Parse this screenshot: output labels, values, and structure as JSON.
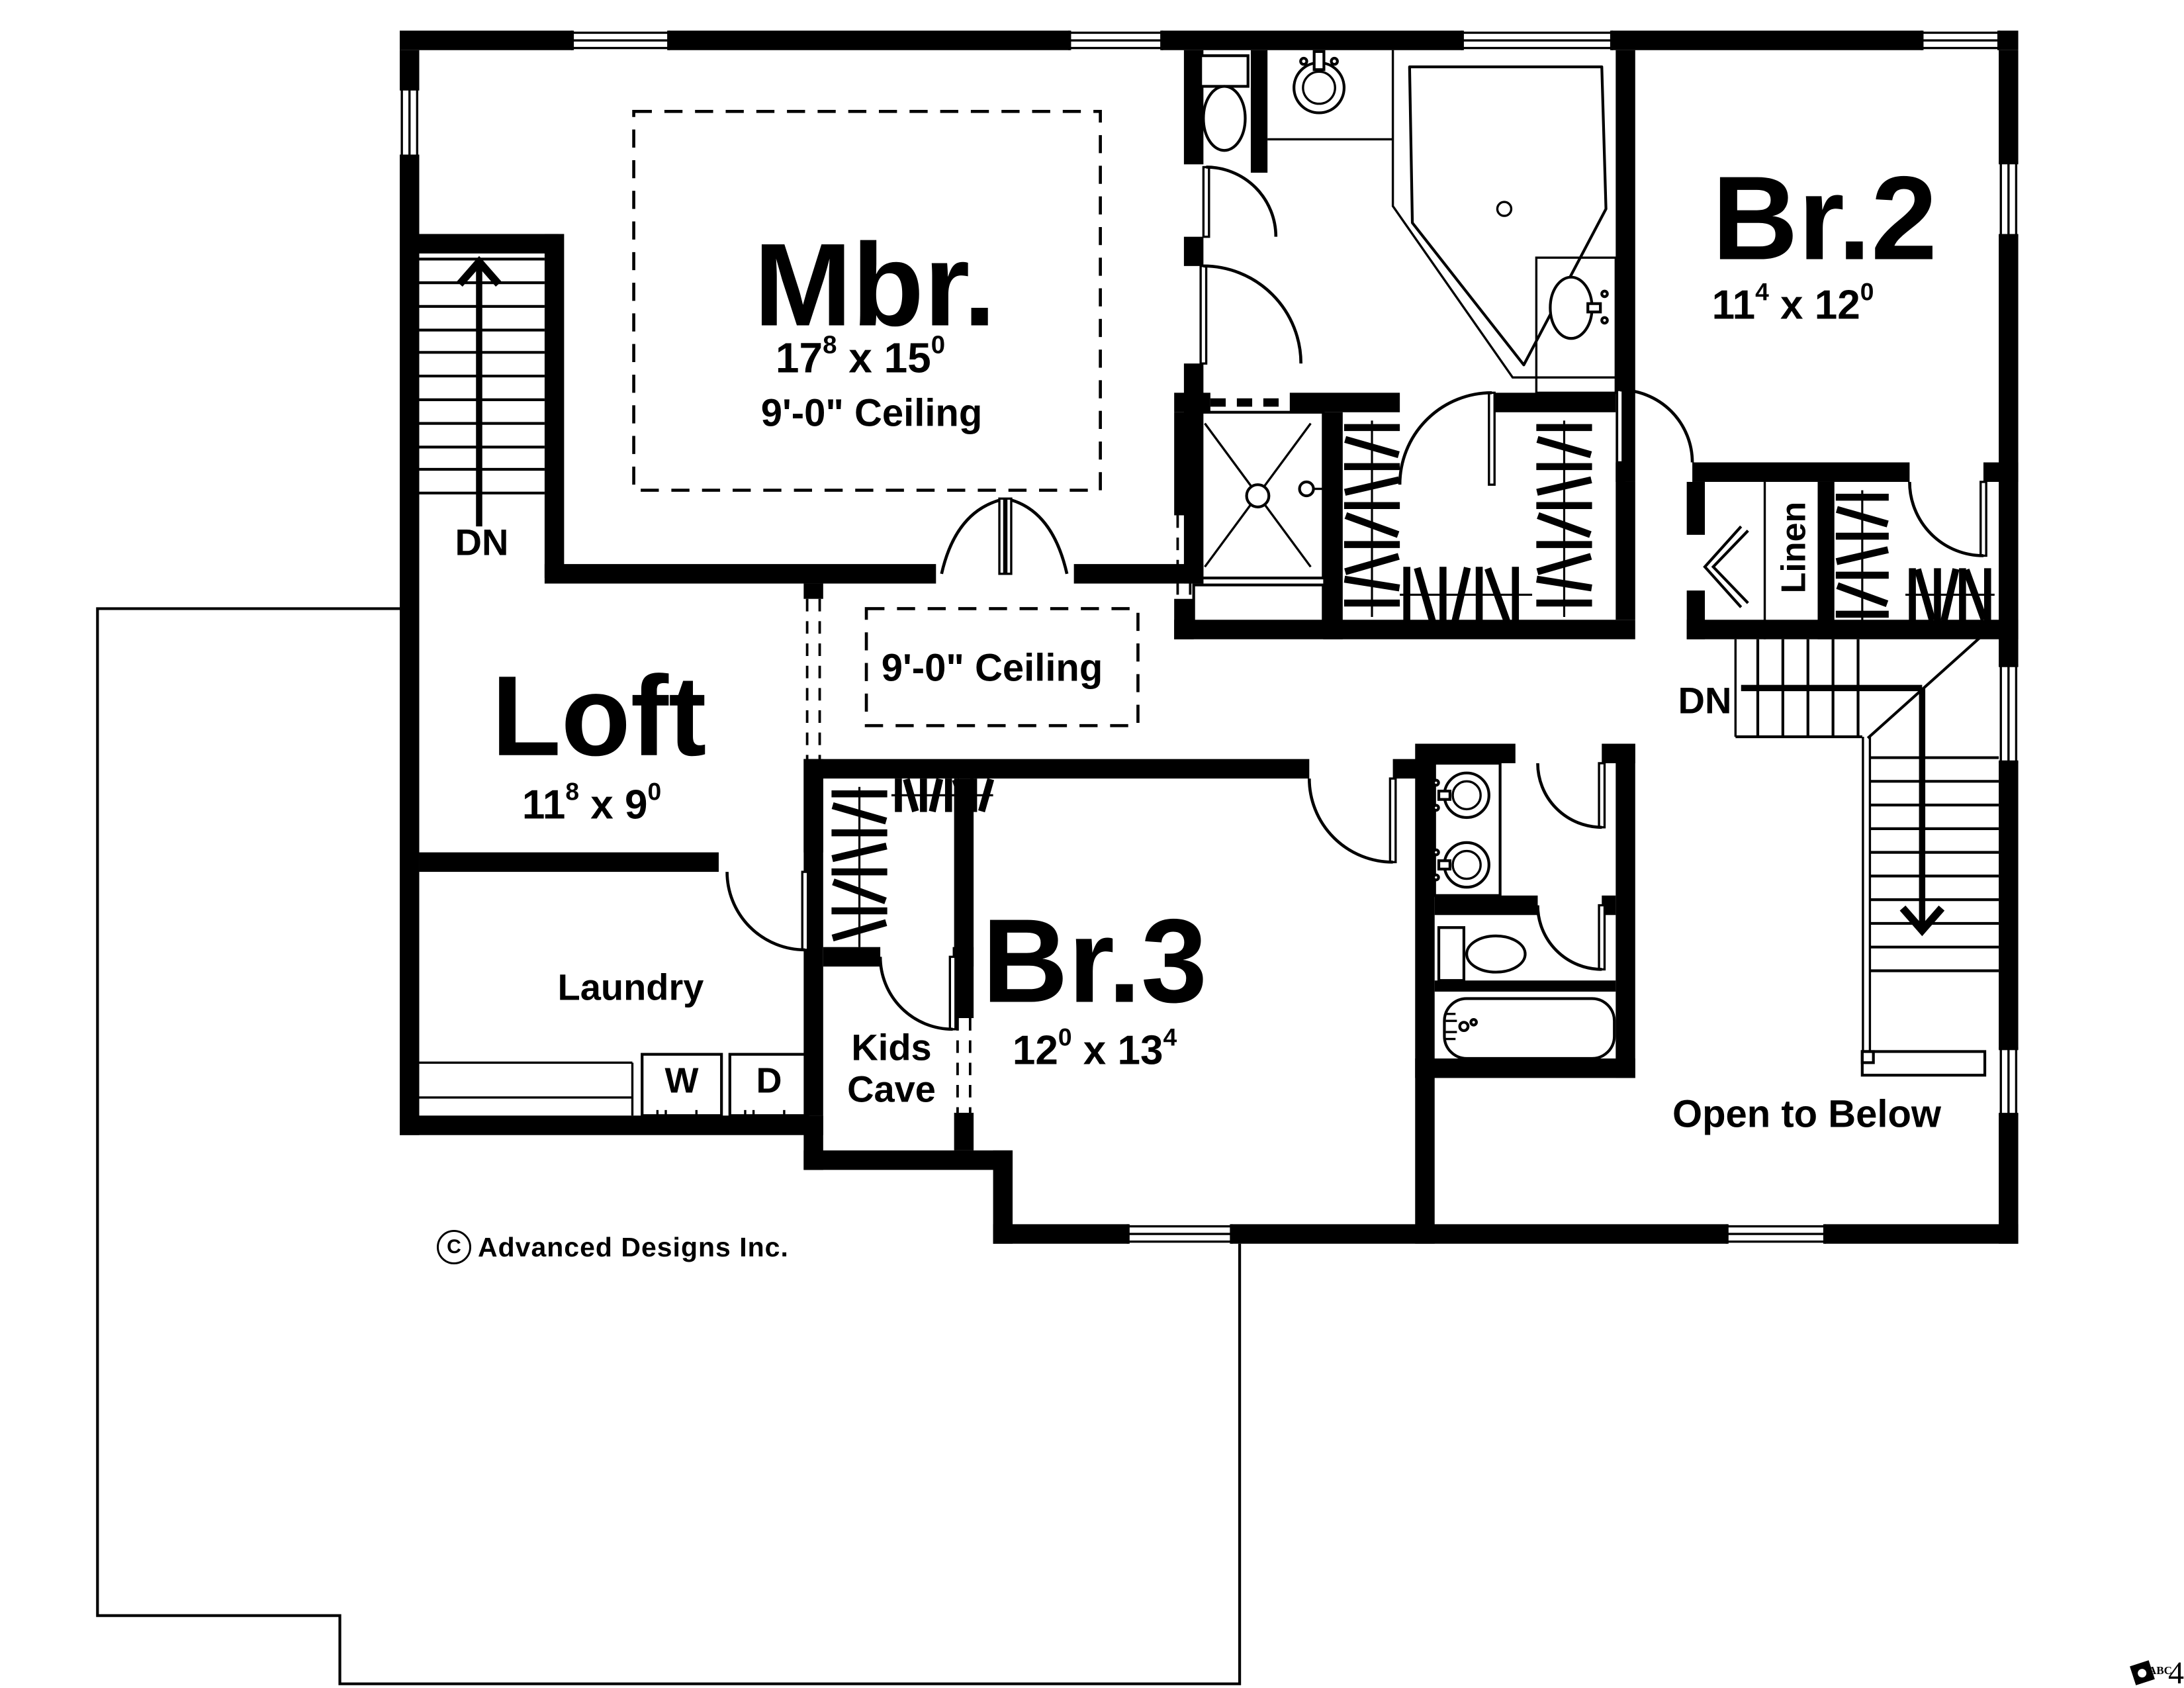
{
  "colors": {
    "ink": "#000000",
    "paper": "#ffffff"
  },
  "rooms": {
    "mbr": {
      "name": "Mbr.",
      "dims": "17^8 x 15^0",
      "ceiling": "9'-0\" Ceiling"
    },
    "loft": {
      "name": "Loft",
      "dims": "11^8 x 9^0"
    },
    "br2": {
      "name": "Br.2",
      "dims": "11^4 x 12^0"
    },
    "br3": {
      "name": "Br.3",
      "dims": "12^0 x 13^4"
    },
    "laundry": {
      "name": "Laundry"
    },
    "kids_cave": {
      "line1": "Kids",
      "line2": "Cave"
    },
    "linen": {
      "name": "Linen"
    },
    "open_to_below": {
      "name": "Open to Below"
    },
    "hall": {
      "ceiling": "9'-0\" Ceiling"
    }
  },
  "annotations": {
    "dn_left": "DN",
    "dn_right": "DN",
    "washer": "W",
    "dryer": "D"
  },
  "footer": {
    "copyright_symbol": "C",
    "copyright_text": "Advanced Designs Inc.",
    "stamp_brand": "ABC",
    "stamp_page": "4"
  },
  "icons": {
    "fixture_names": [
      "toilet-icon",
      "vanity-sink-icon",
      "corner-tub-icon",
      "shower-icon",
      "double-vanity-icon",
      "bathtub-icon",
      "washer-icon",
      "dryer-icon",
      "stairs-up-arrow-icon",
      "stairs-down-arrow-icon",
      "closet-rod-icon",
      "window-icon",
      "door-swing-icon",
      "company-logo-icon"
    ]
  }
}
